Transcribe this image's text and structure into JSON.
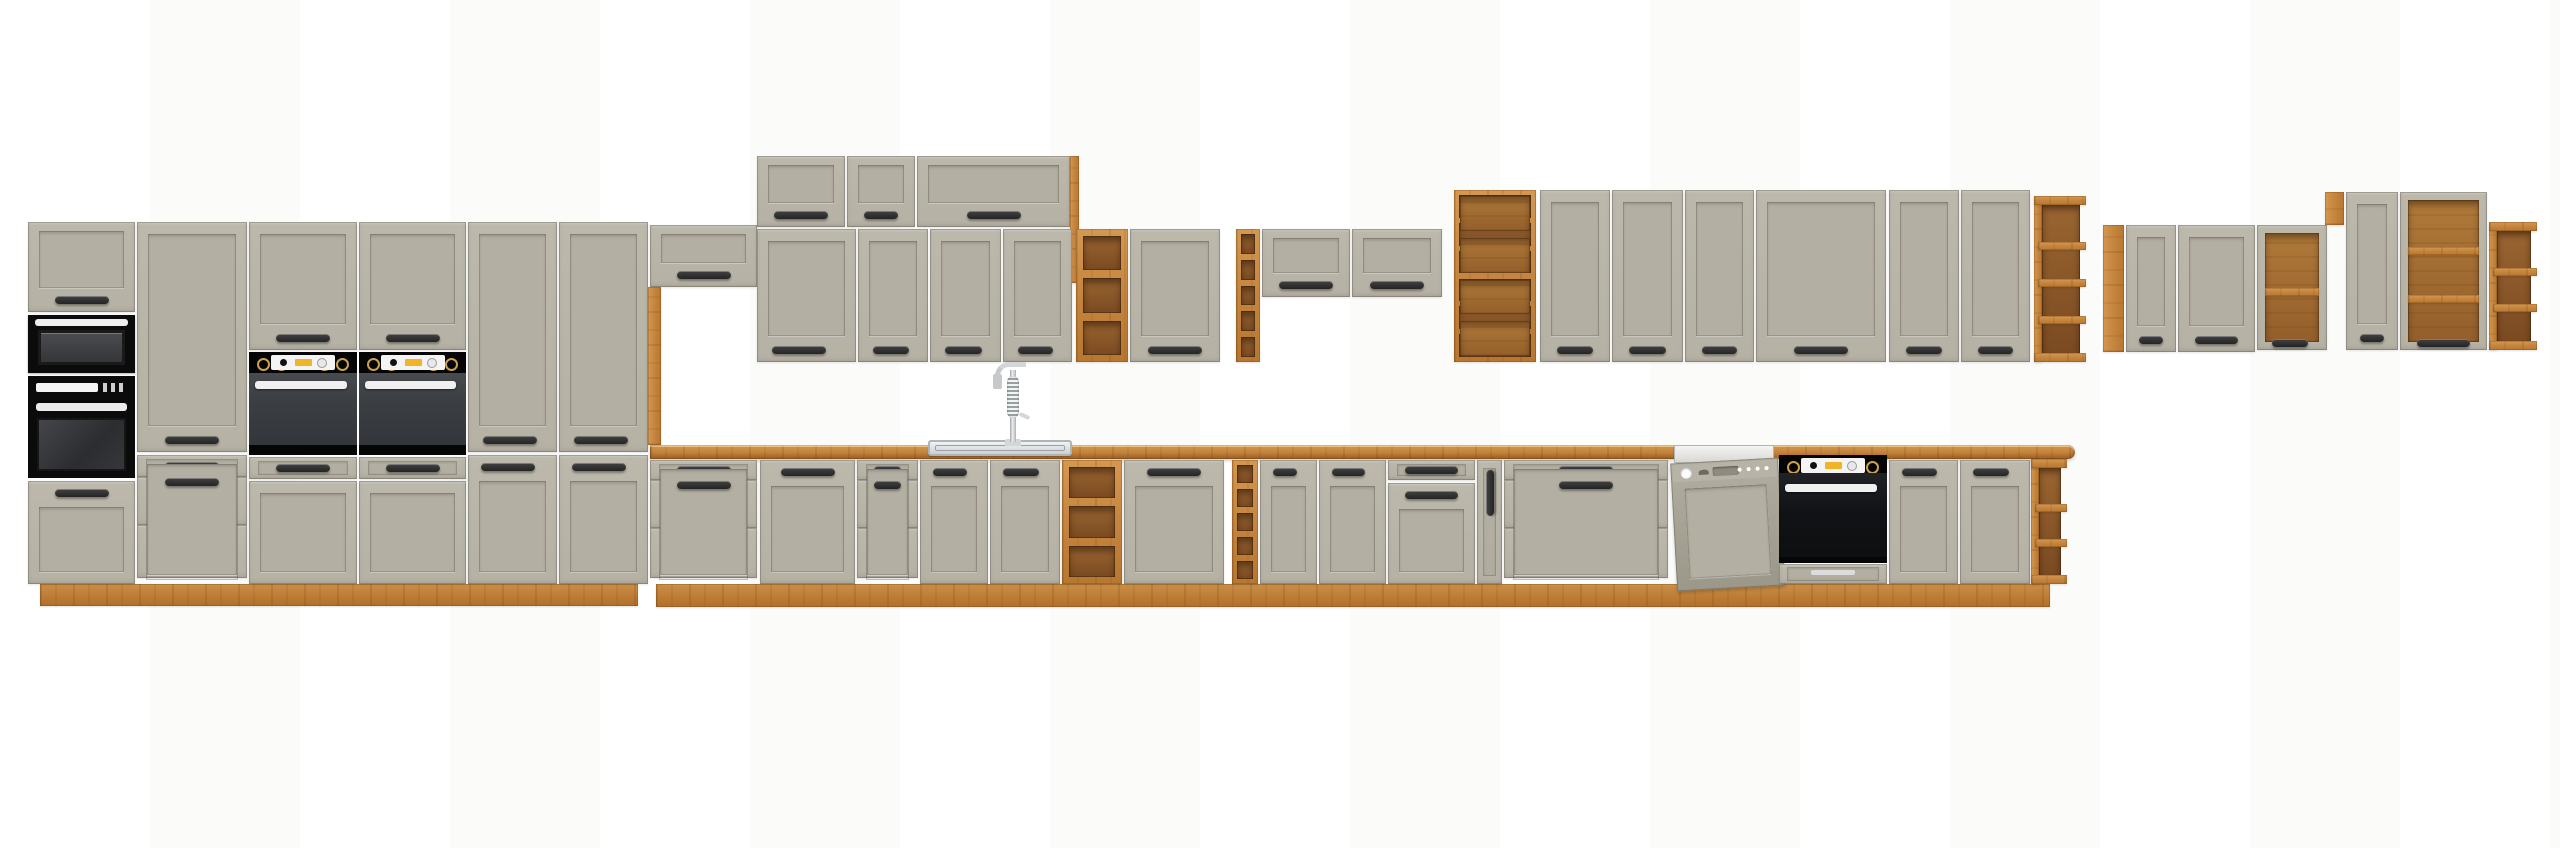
{
  "scene": {
    "width": 2560,
    "height": 848,
    "background": "#ffffff"
  },
  "colors": {
    "front": "#b5b1a4",
    "frontLight": "#bcb8ab",
    "frontPanel": "#b3afa2",
    "oak": "#c5853e",
    "oakLight": "#d49850",
    "oakDark": "#b8772f",
    "oakInterior": "#8a5728",
    "handle": "#242424",
    "applianceBlack": "#0b0b0b",
    "ovenBody": "#3b3e42",
    "silver": "#ededed",
    "dishwasherPanel": "#a8a496",
    "knobYellow": "#f0b428",
    "steel": "#cfd4d6"
  },
  "modules": [
    {
      "id": "tall-unit-plinth",
      "kind": "plinth",
      "x": 40,
      "y": 584,
      "w": 598,
      "h": 22
    },
    {
      "id": "base-run-plinth",
      "kind": "plinth",
      "x": 656,
      "y": 584,
      "w": 1394,
      "h": 23
    },
    {
      "id": "countertop",
      "kind": "counter",
      "x": 650,
      "y": 445,
      "w": 1425,
      "h": 14
    },
    {
      "id": "tall1-flip-door",
      "kind": "flip",
      "x": 28,
      "y": 222,
      "w": 107,
      "h": 90
    },
    {
      "id": "tall1-microwave",
      "kind": "microwave",
      "x": 28,
      "y": 315,
      "w": 107,
      "h": 58
    },
    {
      "id": "tall1-oven",
      "kind": "oven-single",
      "x": 28,
      "y": 376,
      "w": 107,
      "h": 102
    },
    {
      "id": "tall1-lower-door",
      "kind": "door",
      "x": 28,
      "y": 481,
      "w": 107,
      "h": 103,
      "handle": "tc"
    },
    {
      "id": "tall2-pantry-door",
      "kind": "door",
      "x": 137,
      "y": 222,
      "w": 110,
      "h": 230,
      "handle": "bc"
    },
    {
      "id": "tall2-drawers",
      "kind": "drawers",
      "x": 137,
      "y": 455,
      "w": 110,
      "h": 129,
      "rows": [
        22,
        48,
        53
      ]
    },
    {
      "id": "tall3-upper-door",
      "kind": "door",
      "x": 249,
      "y": 222,
      "w": 108,
      "h": 128,
      "handle": "bc"
    },
    {
      "id": "tall3-oven",
      "kind": "oven-duo",
      "x": 249,
      "y": 352,
      "w": 108,
      "h": 103
    },
    {
      "id": "tall3-flip-drawer",
      "kind": "drawers",
      "x": 249,
      "y": 457,
      "w": 108,
      "h": 22,
      "rows": [
        22
      ]
    },
    {
      "id": "tall3-lower-front",
      "kind": "door",
      "x": 249,
      "y": 481,
      "w": 108,
      "h": 103,
      "handle": "none"
    },
    {
      "id": "tall4-upper-door",
      "kind": "door",
      "x": 359,
      "y": 222,
      "w": 107,
      "h": 128,
      "handle": "bc"
    },
    {
      "id": "tall4-oven",
      "kind": "oven-duo",
      "x": 359,
      "y": 352,
      "w": 107,
      "h": 103
    },
    {
      "id": "tall4-flip-drawer",
      "kind": "drawers",
      "x": 359,
      "y": 457,
      "w": 107,
      "h": 22,
      "rows": [
        22
      ]
    },
    {
      "id": "tall4-lower-front",
      "kind": "door",
      "x": 359,
      "y": 481,
      "w": 107,
      "h": 103,
      "handle": "none"
    },
    {
      "id": "tall5-larder-door",
      "kind": "door",
      "x": 468,
      "y": 222,
      "w": 89,
      "h": 230,
      "handle": "bl"
    },
    {
      "id": "tall5-lower-door",
      "kind": "door",
      "x": 468,
      "y": 455,
      "w": 89,
      "h": 129,
      "handle": "tl"
    },
    {
      "id": "tall6-larder-door",
      "kind": "door",
      "x": 559,
      "y": 222,
      "w": 89,
      "h": 230,
      "handle": "bl"
    },
    {
      "id": "tall6-lower-door",
      "kind": "door",
      "x": 559,
      "y": 455,
      "w": 89,
      "h": 129,
      "handle": "tl"
    },
    {
      "id": "hood-flip-cabinet",
      "kind": "flip",
      "x": 650,
      "y": 225,
      "w": 107,
      "h": 62
    },
    {
      "id": "tall-end-side-panel",
      "kind": "woodv",
      "x": 648,
      "y": 287,
      "w": 13,
      "h": 158
    },
    {
      "id": "raised-flip-cab-1",
      "kind": "flip",
      "x": 757,
      "y": 156,
      "w": 88,
      "h": 71
    },
    {
      "id": "raised-flip-cab-2",
      "kind": "flip",
      "x": 847,
      "y": 156,
      "w": 68,
      "h": 71
    },
    {
      "id": "raised-flip-cab-3",
      "kind": "flip",
      "x": 917,
      "y": 156,
      "w": 153,
      "h": 71
    },
    {
      "id": "raised-row-side-panel",
      "kind": "woodv",
      "x": 1070,
      "y": 156,
      "w": 9,
      "h": 127
    },
    {
      "id": "wall-door-1",
      "kind": "door",
      "x": 757,
      "y": 229,
      "w": 99,
      "h": 133,
      "handle": "bl"
    },
    {
      "id": "wall-door-2",
      "kind": "door",
      "x": 858,
      "y": 229,
      "w": 70,
      "h": 133,
      "handle": "bl"
    },
    {
      "id": "wall-door-3",
      "kind": "door",
      "x": 930,
      "y": 229,
      "w": 71,
      "h": 133,
      "handle": "bl"
    },
    {
      "id": "wall-door-4",
      "kind": "door",
      "x": 1003,
      "y": 229,
      "w": 69,
      "h": 133,
      "handle": "bl"
    },
    {
      "id": "wall-open-shelf",
      "kind": "openshelf",
      "x": 1076,
      "y": 229,
      "w": 52,
      "h": 133,
      "shelves": 2
    },
    {
      "id": "wall-door-5",
      "kind": "door",
      "x": 1130,
      "y": 229,
      "w": 90,
      "h": 133,
      "handle": "bc"
    },
    {
      "id": "wall-wine-rack",
      "kind": "winerack",
      "x": 1236,
      "y": 229,
      "w": 24,
      "h": 133,
      "cells": 5
    },
    {
      "id": "wall-flip-cab-1",
      "kind": "flip",
      "x": 1262,
      "y": 229,
      "w": 88,
      "h": 68
    },
    {
      "id": "wall-flip-cab-2",
      "kind": "flip",
      "x": 1352,
      "y": 229,
      "w": 90,
      "h": 68
    },
    {
      "id": "wall-combo-shelf",
      "kind": "combo",
      "x": 1454,
      "y": 190,
      "w": 82,
      "h": 172
    },
    {
      "id": "wall-door-6",
      "kind": "door",
      "x": 1540,
      "y": 190,
      "w": 70,
      "h": 172,
      "handle": "bc"
    },
    {
      "id": "wall-door-7",
      "kind": "door",
      "x": 1612,
      "y": 190,
      "w": 71,
      "h": 172,
      "handle": "bc"
    },
    {
      "id": "wall-door-8",
      "kind": "door",
      "x": 1685,
      "y": 190,
      "w": 69,
      "h": 172,
      "handle": "bc"
    },
    {
      "id": "wall-door-9-wide",
      "kind": "door",
      "x": 1756,
      "y": 190,
      "w": 130,
      "h": 172,
      "handle": "bc"
    },
    {
      "id": "wall-door-10",
      "kind": "door",
      "x": 1889,
      "y": 190,
      "w": 70,
      "h": 172,
      "handle": "bc"
    },
    {
      "id": "wall-door-11",
      "kind": "door",
      "x": 1961,
      "y": 190,
      "w": 69,
      "h": 172,
      "handle": "bc"
    },
    {
      "id": "wall-end-open-shelf",
      "kind": "endshelf",
      "x": 2034,
      "y": 196,
      "w": 46,
      "h": 166,
      "tabs": 3
    },
    {
      "id": "right-group-side-panel",
      "kind": "woodv",
      "x": 2103,
      "y": 225,
      "w": 21,
      "h": 127
    },
    {
      "id": "right-group-door-1",
      "kind": "door",
      "x": 2126,
      "y": 225,
      "w": 50,
      "h": 127,
      "handle": "bc"
    },
    {
      "id": "right-group-door-2",
      "kind": "door",
      "x": 2178,
      "y": 225,
      "w": 77,
      "h": 127,
      "handle": "bc"
    },
    {
      "id": "right-group-open-cab-1",
      "kind": "opencab",
      "x": 2257,
      "y": 225,
      "w": 70,
      "h": 125,
      "shelves": 1,
      "handle": "bl"
    },
    {
      "id": "right-group-filler-block",
      "kind": "woodv",
      "x": 2325,
      "y": 192,
      "w": 19,
      "h": 33
    },
    {
      "id": "right-group-door-3",
      "kind": "door",
      "x": 2346,
      "y": 192,
      "w": 52,
      "h": 158,
      "handle": "bc"
    },
    {
      "id": "right-group-open-cab-2",
      "kind": "opencab",
      "x": 2400,
      "y": 192,
      "w": 87,
      "h": 158,
      "shelves": 2,
      "handle": "bc"
    },
    {
      "id": "right-group-end-shelf",
      "kind": "endshelf",
      "x": 2489,
      "y": 222,
      "w": 42,
      "h": 128,
      "tabs": 2
    },
    {
      "id": "base-drawers-1",
      "kind": "drawers",
      "x": 650,
      "y": 460,
      "w": 107,
      "h": 124,
      "rows": [
        20,
        48,
        50
      ]
    },
    {
      "id": "base-door-1",
      "kind": "door",
      "x": 760,
      "y": 460,
      "w": 95,
      "h": 124,
      "handle": "tc"
    },
    {
      "id": "base-drawers-2",
      "kind": "drawers",
      "x": 857,
      "y": 460,
      "w": 61,
      "h": 124,
      "rows": [
        20,
        48,
        50
      ]
    },
    {
      "id": "base-sink-door-1",
      "kind": "door",
      "x": 920,
      "y": 460,
      "w": 68,
      "h": 124,
      "handle": "tl"
    },
    {
      "id": "base-sink-door-2",
      "kind": "door",
      "x": 990,
      "y": 460,
      "w": 70,
      "h": 124,
      "handle": "tl"
    },
    {
      "id": "base-open-shelf",
      "kind": "openshelf",
      "x": 1062,
      "y": 460,
      "w": 60,
      "h": 124,
      "shelves": 2
    },
    {
      "id": "base-door-2-wide",
      "kind": "door",
      "x": 1124,
      "y": 460,
      "w": 100,
      "h": 124,
      "handle": "tc"
    },
    {
      "id": "base-wine-rack",
      "kind": "winerack",
      "x": 1232,
      "y": 460,
      "w": 26,
      "h": 124,
      "cells": 5
    },
    {
      "id": "base-door-3",
      "kind": "door",
      "x": 1260,
      "y": 460,
      "w": 57,
      "h": 124,
      "handle": "tl"
    },
    {
      "id": "base-door-4",
      "kind": "door",
      "x": 1319,
      "y": 460,
      "w": 67,
      "h": 124,
      "handle": "tl"
    },
    {
      "id": "base-drawer-over-door",
      "kind": "drawers",
      "x": 1388,
      "y": 460,
      "w": 87,
      "h": 20,
      "rows": [
        20
      ]
    },
    {
      "id": "base-drawer-door",
      "kind": "door",
      "x": 1388,
      "y": 483,
      "w": 87,
      "h": 101,
      "handle": "tc"
    },
    {
      "id": "base-pullout-cargo",
      "kind": "pullout",
      "x": 1477,
      "y": 460,
      "w": 25,
      "h": 124
    },
    {
      "id": "base-drawers-3-wide",
      "kind": "drawers",
      "x": 1504,
      "y": 460,
      "w": 164,
      "h": 124,
      "rows": [
        20,
        48,
        50
      ]
    },
    {
      "id": "dishwasher",
      "kind": "dishwasher",
      "x": 1670,
      "y": 445,
      "w": 108,
      "h": 143
    },
    {
      "id": "base-oven",
      "kind": "oven-base",
      "x": 1779,
      "y": 455,
      "w": 108,
      "h": 129
    },
    {
      "id": "base-door-5",
      "kind": "door",
      "x": 1889,
      "y": 460,
      "w": 69,
      "h": 124,
      "handle": "tl"
    },
    {
      "id": "base-door-6",
      "kind": "door",
      "x": 1960,
      "y": 460,
      "w": 70,
      "h": 124,
      "handle": "tl"
    },
    {
      "id": "base-end-shelf",
      "kind": "endshelf",
      "x": 2031,
      "y": 459,
      "w": 30,
      "h": 125,
      "tabs": 2
    },
    {
      "id": "sink",
      "kind": "sink",
      "x": 928,
      "y": 440,
      "w": 140,
      "h": 12
    },
    {
      "id": "faucet",
      "kind": "faucet",
      "x": 993,
      "y": 362,
      "w": 44,
      "h": 84
    }
  ]
}
